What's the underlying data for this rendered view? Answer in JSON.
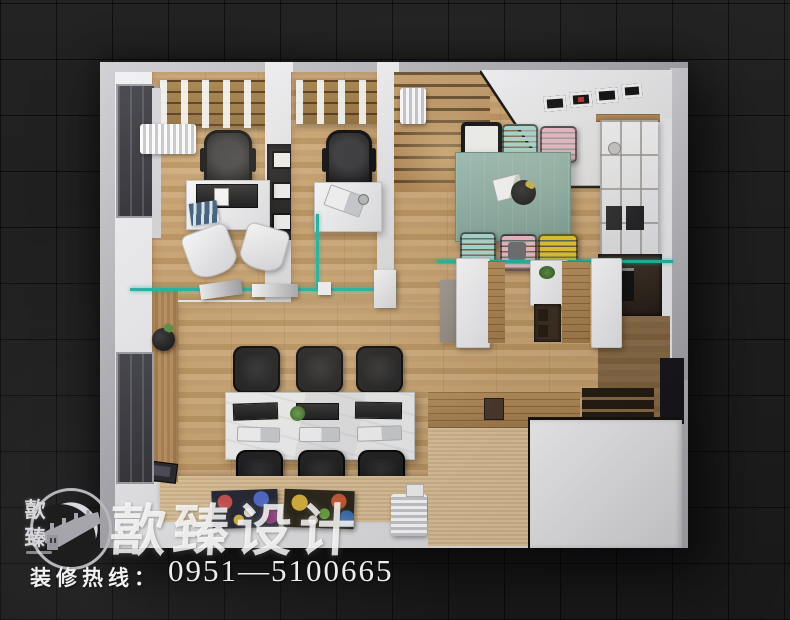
{
  "brand": {
    "watermark_text": "歖臻设计",
    "logo_char_top": "歖",
    "logo_char_bottom": "臻",
    "logo_emblem_icon": "great-wall-icon"
  },
  "footer": {
    "hotline_label": "装修热线：",
    "phone_number": "0951—5100665"
  },
  "palette": {
    "background": "#1c1c1c",
    "outer_wall_gray": "#c3c3c8",
    "interior_white": "#ececee",
    "wood_floor": "#c9a772",
    "wood_dark": "#a87f4e",
    "glass_teal": "#27b3a2",
    "dining_table_teal": "#8fb3a9",
    "chair_mint": "#abdbd1",
    "chair_pink": "#ecbcc8",
    "chair_yellow": "#e5c531",
    "chair_black": "#1a1a1c",
    "worktable_white": "#ededef"
  }
}
